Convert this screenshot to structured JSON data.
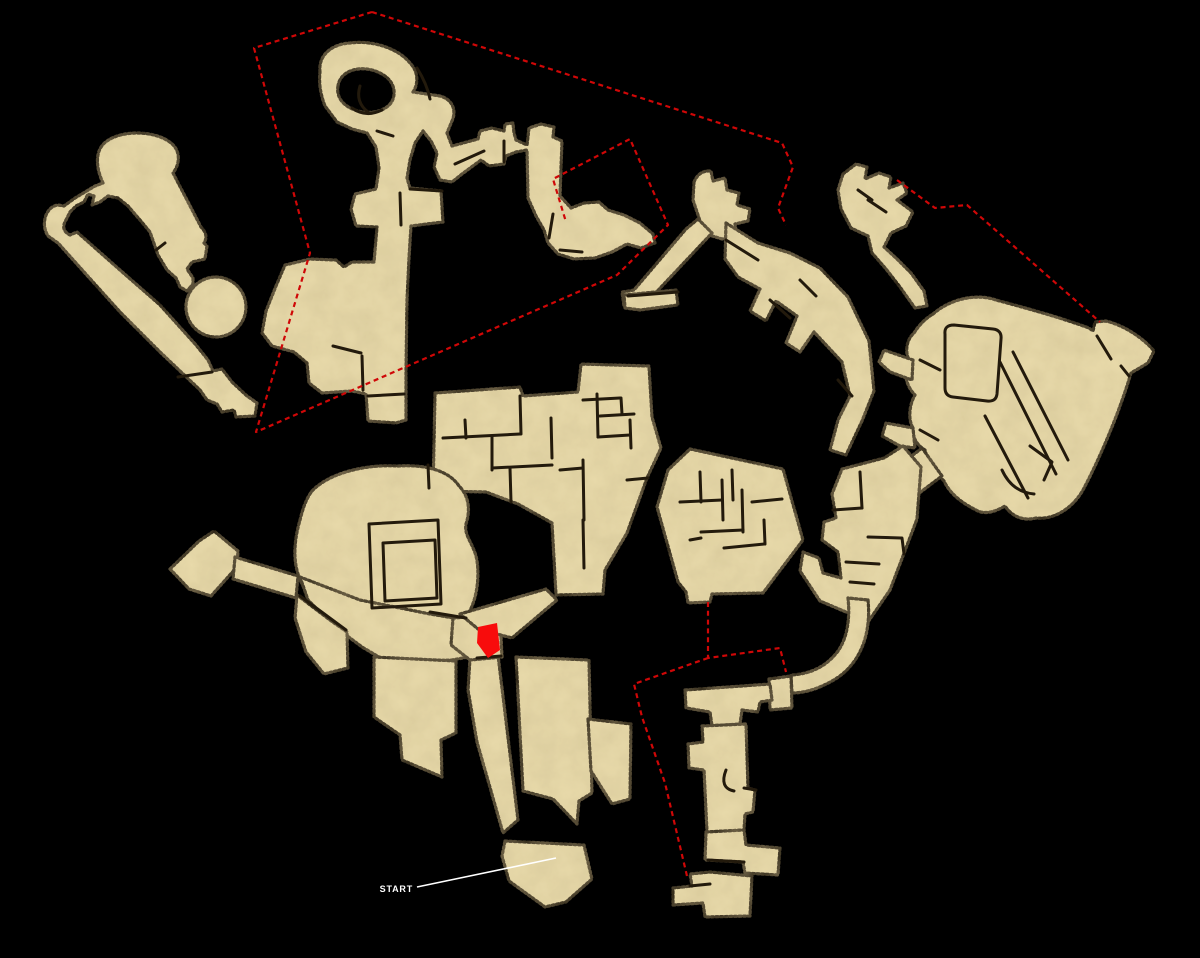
{
  "meta": {
    "width": 1200,
    "height": 958
  },
  "palette": {
    "background": "#000000",
    "parchment": "#e9dbab",
    "mottle": "#8a6f3f",
    "outline": "#1a120a",
    "wall": "#231a0c",
    "red_line": "#cf0707",
    "marker_red": "#f80c0c",
    "white": "#ffffff"
  },
  "style": {
    "edge_width": 3.2,
    "edge_dash": "2 2.6",
    "wall_width": 3,
    "red_width": 2.2,
    "red_dash": "5 3.8",
    "callout_width": 1.6,
    "start_font_size": 9
  },
  "labels": {
    "start": "START"
  },
  "start_callout": {
    "text_x": 413,
    "text_y": 892,
    "line_x1": 417,
    "line_y1": 887,
    "line_x2": 556,
    "line_y2": 858
  },
  "marker": {
    "name": "current-location-marker",
    "points": "478,627 497,623 500,650 488,658 477,643"
  },
  "connectors": [
    {
      "name": "link-north-to-northeast",
      "d": "M372,12 L782,143 L793,167 L778,208 L786,225"
    },
    {
      "name": "link-north-boundary",
      "d": "M372,12 L254,48 L310,253 L256,432 L617,275 L668,225 L630,139 L553,179 L566,222"
    },
    {
      "name": "link-northeast-to-east-blob",
      "d": "M897,180 L935,208 L967,205 L1100,322"
    },
    {
      "name": "link-east-bastion-to-chain",
      "d": "M708,602 L708,658 L780,648 L786,672"
    },
    {
      "name": "link-east-bastion-to-south-stair",
      "d": "M708,658 L634,684 L642,717 L665,783 L687,876"
    }
  ],
  "regions": [
    {
      "name": "northwest-loop",
      "chunks": [
        "M103,183 C95,166 95,149 107,141 C122,130 155,130 171,143 C181,151 180,164 173,173 L201,227 Q209,235 204,243 L207,246 L205,259 L192,262 L187,269 L193,278 L193,284 L187,291 L180,287 L176,278 L167,270 L158,255 L150,232 L140,220 L128,206 L118,198 L108,196 L100,202 L92,205 L94,196 L88,194 L84,202 L76,206 L70,212 L66,220 Q60,230 70,235 L77,232 L120,270 L160,305 L196,345 L208,360 L213,371 L222,369 L232,382 L247,396 L257,403 L255,416 L236,417 L234,410 L222,412 L217,404 L207,400 L200,390 L160,352 L120,312 L84,272 L58,243 L48,236 Q42,226 46,215 Q50,206 58,205 L64,206 L75,198 L85,192 L95,186 Z",
        "M216,277 A30,30 0 1 1 215.9,277 Z"
      ],
      "walls": [
        "M178,377 L212,372",
        "M156,250 L165,243"
      ]
    },
    {
      "name": "north-figure",
      "chunks": [
        "M320,72 C318,55 332,44 350,43 C372,40 398,48 410,63 C418,71 419,83 413,92 L440,96 C452,99 457,110 452,121 L447,133 L452,146 L478,139 L480,131 L492,128 L504,131 L505,124 L513,123 L514,133 L516,140 L527,145 L529,128 L541,124 L554,127 L553,137 L562,141 L560,196 L571,208 L584,203 L599,202 L608,210 L624,215 L640,223 L653,234 L655,243 L641,248 L627,244 L612,252 L595,258 L574,259 L558,254 L548,243 L544,230 L536,216 L528,198 L527,150 L516,152 L506,156 L504,164 L489,166 L481,160 L462,174 L452,182 L440,180 L434,167 L437,153 L431,141 L423,131 L415,143 L410,160 L407,178 L410,188 L441,191 L443,222 L411,226 L409,258 L407,300 L406,372 L406,420 L396,423 L368,421 L366,394 L352,391 L322,393 L309,383 L307,363 L294,352 L272,346 L262,333 L266,311 L276,286 L285,265 L310,259 L336,260 L344,267 L352,262 L374,262 L377,227 L356,226 L351,209 L355,194 L376,189 L379,168 L376,147 L367,133 L352,129 L337,122 L325,106 Q318,88 320,72 Z M338,86 C340,72 356,66 372,70 C390,75 397,87 393,99 C389,110 373,115 358,111 C344,107 336,98 338,86 Z"
      ],
      "walls": [
        "M352,108 Q366,118 382,110",
        "M360,86 Q355,102 368,112",
        "M417,68 Q427,84 430,99",
        "M377,131 L393,136",
        "M455,164 L484,151",
        "M504,141 L504,162",
        "M410,189 L442,191",
        "M400,193 L401,225",
        "M333,346 L361,353",
        "M362,356 L363,390",
        "M368,396 L404,394",
        "M553,214 L549,238",
        "M560,250 L582,252"
      ]
    },
    {
      "name": "northeast-spur",
      "chunks": [
        "M694,182 Q699,170 711,171 L713,181 L725,178 L727,190 L739,193 L737,205 L750,209 L748,221 L735,224 L737,236 L722,239 L709,235 L700,221 L693,200 Z",
        "M698,219 L712,233 L648,301 L640,310 L624,306 L622,292 L634,290 L686,229 Z",
        "M624,295 L676,290 L678,305 L640,310 L625,308 Z",
        "M726,223 L758,243 L790,253 L820,268 L848,297 L869,341 L874,391 L862,421 L846,455 L830,450 L838,420 L850,396 L842,362 L814,332 L800,352 L786,343 L797,316 L776,301 L766,321 L750,311 L760,289 L738,277 L725,259 Z"
      ],
      "walls": [
        "M726,240 L758,260",
        "M770,300 L790,318",
        "M800,280 L816,296",
        "M838,380 L852,396",
        "M628,296 L678,292"
      ]
    },
    {
      "name": "northeast-annex",
      "chunks": [
        "M843,174 L856,164 L867,167 L865,179 L879,173 L891,177 L889,188 L903,183 L907,193 L897,200 L913,212 L906,226 L891,233 L884,247 L897,259 L911,273 L924,291 L927,306 L915,308 L900,287 L886,269 L872,253 L868,236 L851,228 L841,209 L838,190 Z"
      ],
      "walls": [
        "M868,200 L886,212",
        "M858,190 L872,200"
      ]
    },
    {
      "name": "central-keep",
      "chunks": [
        "M435,393 L520,387 L523,396 L578,392 L581,364 L649,366 L652,417 L661,448 L647,478 L627,533 L605,570 L603,594 L556,595 L552,523 L518,504 L486,492 L433,491 Z"
      ],
      "walls": [
        "M443,438 L520,434",
        "M465,420 L466,438",
        "M492,436 L492,470",
        "M520,396 L521,434",
        "M551,418 L552,458",
        "M492,468 L552,465",
        "M510,468 L511,502",
        "M597,394 L598,437",
        "M583,400 L620,398",
        "M621,398 L622,414",
        "M600,416 L634,414",
        "M598,437 L630,435",
        "M630,420 L631,448",
        "M583,460 L584,520",
        "M560,470 L583,468",
        "M583,520 L584,568",
        "M627,480 L648,478"
      ]
    },
    {
      "name": "great-hall-west",
      "chunks": [
        "M312,491 C330,472 368,464 398,466 C428,464 450,472 459,486 C470,497 470,512 466,524 C464,535 472,542 476,556 C480,572 478,598 468,614 C460,627 444,632 430,628 C415,624 402,630 388,634 C370,638 352,633 338,624 C322,613 306,596 299,577 C292,558 295,537 300,520 C303,508 306,499 312,491 Z",
        "M170,569 L199,541 L214,531 L238,551 L237,567 L211,596 L189,589 Z",
        "M235,557 L298,576 L296,598 L233,579 Z",
        "M300,577 L360,600 L430,614 L466,620 L478,632 L474,656 L452,660 L412,662 L384,660 L362,647 L334,626 L308,600 Z",
        "M297,595 L330,620 L347,632 L348,668 L324,674 L306,652 L295,618 Z",
        "M374,657 L456,661 L456,733 L441,740 L442,777 L402,760 L400,735 L374,717 Z",
        "M470,658 L498,655 L518,820 L503,833 L477,742 L468,690 Z",
        "M516,657 L589,660 L592,793 L579,801 L577,824 L553,799 L523,791 Z",
        "M505,841 L584,845 L592,879 L566,902 L545,907 L509,881 L502,856 Z",
        "M588,719 L631,724 L630,799 L612,804 L591,771 Z",
        "M453,618 L500,615 L502,657 L470,660 L451,645 Z",
        "M460,614 L546,589 L557,600 L512,638 L478,629 Z"
      ],
      "walls": [
        "M369,524 L438,520 L441,604 L372,608 Z",
        "M383,543 L435,540 L437,598 L385,601 Z",
        "M428,465 L429,488",
        "M300,596 L346,630",
        "M430,612 L466,618",
        "M477,658 L501,656"
      ]
    },
    {
      "name": "east-bastion",
      "chunks": [
        "M690,449 L783,469 L803,540 L763,593 L712,594 L710,602 L688,603 L686,592 L678,582 L657,507 L668,470 Z"
      ],
      "walls": [
        "M700,472 L701,502",
        "M680,502 L722,500",
        "M722,480 L723,520",
        "M742,490 L743,532",
        "M701,532 L743,530",
        "M724,548 L764,544",
        "M752,502 L782,499",
        "M732,470 L733,500",
        "M764,520 L765,544",
        "M690,540 L701,538"
      ]
    },
    {
      "name": "east-chain",
      "chunks": [
        "M933,314 C950,299 976,293 996,300 C1022,307 1056,316 1089,328 L1093,331 L1095,322 L1106,321 C1126,326 1144,339 1154,351 L1148,363 L1131,373 C1120,410 1102,454 1083,490 C1071,511 1051,520 1036,518 C1021,522 1010,514 1005,506 C995,512 984,515 976,510 C962,503 950,494 944,481 C935,472 928,462 925,450 C918,446 912,438 913,428 C908,420 909,405 915,395 C905,385 903,370 909,360 C905,352 906,340 914,333 C919,325 926,318 933,314 Z",
        "M913,360 L884,350 L879,362 L890,372 L912,380 Z",
        "M913,428 L886,423 L882,436 L900,446 L915,448 Z",
        "M922,448 L942,476 L918,494 L896,468 Z",
        "M842,469 L884,458 L903,446 L921,467 L917,519 L903,556 L890,590 L868,622 L846,612 L820,601 L800,571 L803,552 L819,558 L823,573 L841,578 L838,552 L822,540 L824,522 L836,518 L832,494 Z",
        "M868,600 C872,640 856,668 832,681 C818,689 804,693 792,693 L791,675 C810,674 826,667 838,651 C848,637 850,616 848,598 Z",
        "M769,679 L791,676 L792,708 L770,710 Z"
      ],
      "walls": [
        "M945,334 Q944,325 954,325 L993,329 Q1002,330 1001,339 L997,394 Q996,402 987,401 L953,397 Q945,396 945,388 Z",
        "M1000,362 L1056,474",
        "M1013,352 L1068,460",
        "M985,416 L1028,498",
        "M1030,446 L1052,462 L1044,480",
        "M1002,470 Q1012,492 1034,494",
        "M1097,336 L1111,359",
        "M1121,366 L1129,376",
        "M920,360 L940,370",
        "M920,430 L938,440",
        "M860,472 L862,508",
        "M833,510 L862,508",
        "M868,537 L901,538",
        "M902,538 L904,554",
        "M846,562 L879,564",
        "M850,582 L874,584"
      ]
    },
    {
      "name": "south-stair",
      "chunks": [
        "M685,690 L770,684 L772,700 L760,702 L758,712 L742,710 L740,724 L712,726 L710,712 L686,708 Z",
        "M702,726 L746,724 L748,788 L755,790 L753,812 L745,814 L744,830 L707,832 L704,770 L689,768 L688,744 L703,742 Z",
        "M706,832 L744,830 L746,845 L780,848 L778,875 L745,873 L743,862 L705,860 Z",
        "M673,888 L692,886 L690,874 L710,872 L752,876 L750,916 L705,917 L703,903 L673,905 Z"
      ],
      "walls": [
        "M726,770 Q719,788 734,791",
        "M744,788 L756,790",
        "M708,860 L744,862",
        "M690,886 L710,884"
      ]
    }
  ]
}
